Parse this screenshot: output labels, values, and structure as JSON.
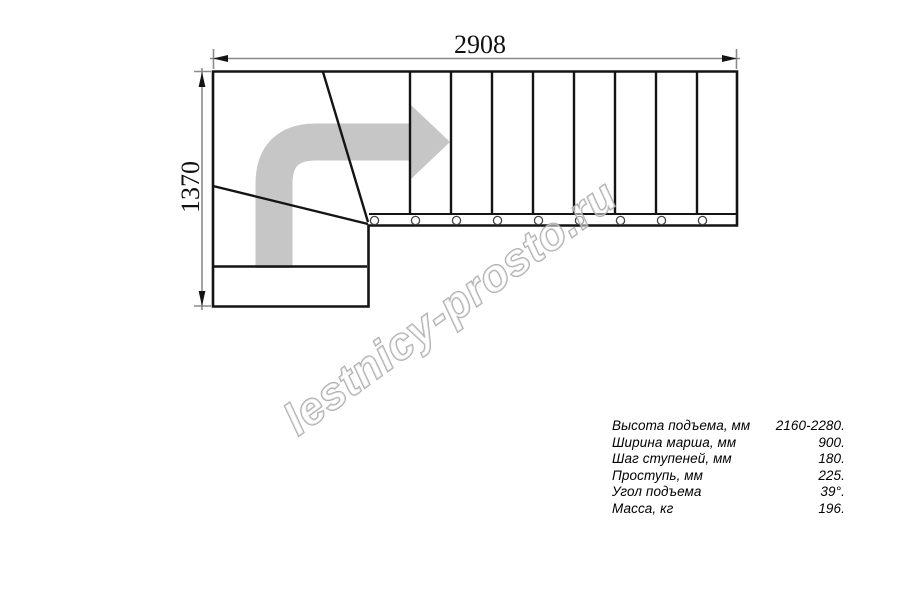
{
  "drawing": {
    "width_dim": "2908",
    "height_dim": "1370",
    "watermark": "lestnicy-prosto.ru"
  },
  "specs": {
    "rows": [
      {
        "label": "Высота подъема, мм",
        "value": "2160-2280."
      },
      {
        "label": "Ширина марша, мм",
        "value": "900."
      },
      {
        "label": "Шаг ступеней, мм",
        "value": "180."
      },
      {
        "label": "Проступь, мм",
        "value": "225."
      },
      {
        "label": "Угол подъема",
        "value": "39°."
      },
      {
        "label": "Масса, кг",
        "value": "196."
      }
    ]
  },
  "colors": {
    "line": "#141414",
    "dim_line": "#8a8a8a",
    "arrow": "#c6c6c6",
    "watermark_stroke": "#9a9a9a",
    "text": "#000000"
  }
}
